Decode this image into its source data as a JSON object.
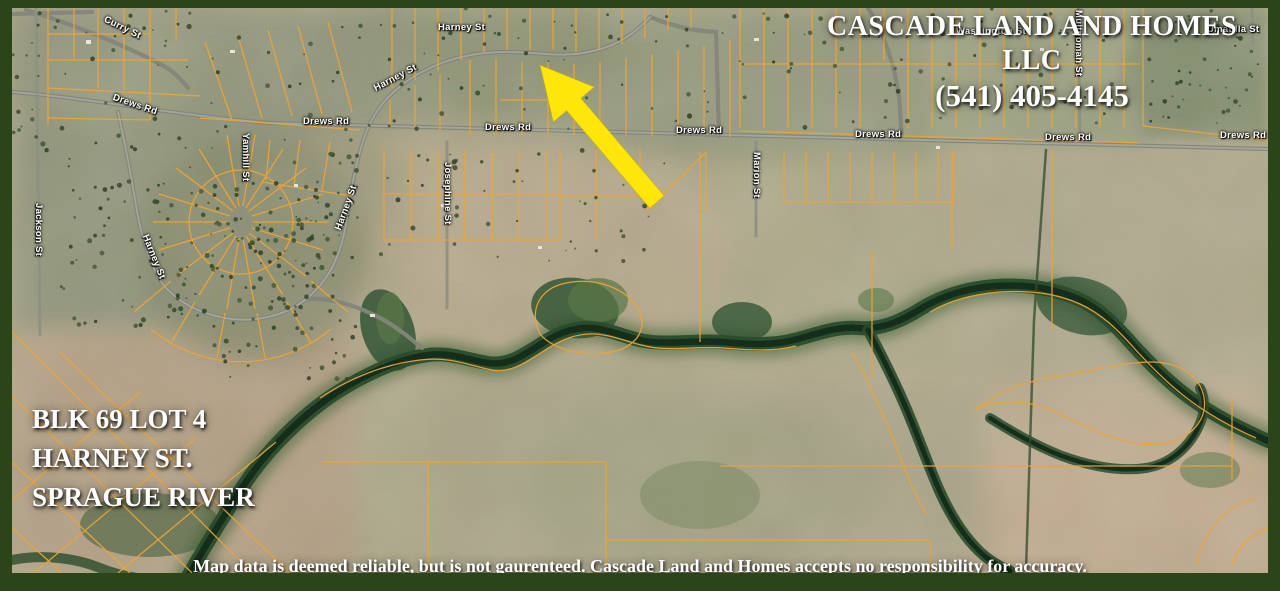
{
  "branding": {
    "company": "CASCADE LAND AND HOMES LLC",
    "phone": "(541) 405-4145"
  },
  "property": {
    "line1": "BLK 69 LOT 4",
    "line2": "HARNEY ST.",
    "line3": "SPRAGUE RIVER"
  },
  "disclaimer": "Map data is deemed reliable, but is not gaurenteed. Cascade Land and Homes accepts no responsibility for accuracy.",
  "streets": [
    {
      "label": "Curry St"
    },
    {
      "label": "Drews Rd"
    },
    {
      "label": "Drews Rd"
    },
    {
      "label": "Drews Rd"
    },
    {
      "label": "Drews Rd"
    },
    {
      "label": "Drews Rd"
    },
    {
      "label": "Drews Rd"
    },
    {
      "label": "Drews Rd"
    },
    {
      "label": "Harney St"
    },
    {
      "label": "Harney St"
    },
    {
      "label": "Harney St"
    },
    {
      "label": "Harney St"
    },
    {
      "label": "Jackson St"
    },
    {
      "label": "Yamhill St"
    },
    {
      "label": "Josephine St"
    },
    {
      "label": "Marion St"
    },
    {
      "label": "Multnomah St"
    },
    {
      "label": "Washington St"
    },
    {
      "label": "Umatilla St"
    }
  ],
  "colors": {
    "frame_green": "#2b4519",
    "parcel_orange": "#eca438",
    "arrow_yellow": "#ffe60a",
    "road_gray": "#9a9c8e",
    "river_dark": "#142e1b",
    "riparian_green": "#2a4c2b"
  }
}
